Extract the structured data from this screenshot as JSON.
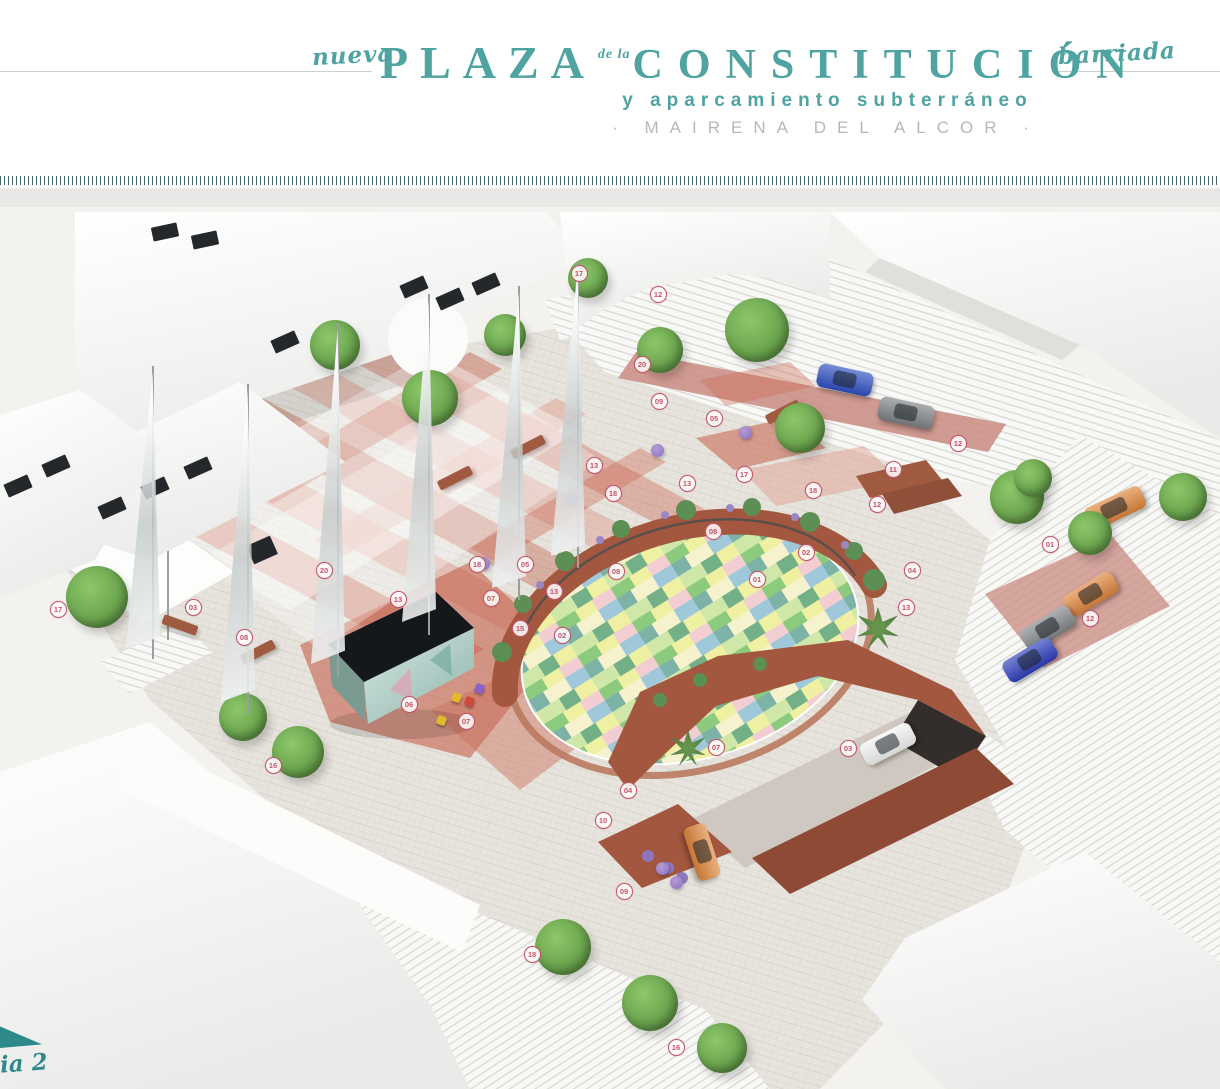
{
  "header": {
    "pre_title": "nueva",
    "title_main": "PLAZA",
    "title_connector": "de la",
    "title_secondary": "CONSTITUCIÓN",
    "post_title": "barriada",
    "subtitle": "y aparcamiento subterráneo",
    "location": "· MAIRENA  DEL  ALCOR ·"
  },
  "logo": {
    "visible_text": "ia 2"
  },
  "palette": {
    "accent": "#4fa3a1",
    "accentDark": "#2e8a8a",
    "locGray": "#b5b8ba",
    "marker": "#c2556b",
    "wall": "#a3573e",
    "redBand": "#cd6c58",
    "pave": "#e7e4de",
    "sceneBg": "#f3f2ee",
    "mosaicColors": "#8ccb7e #eff0a2 #f2cdd1 #7db3a6 #9fc9da #f6f2cd #cfe7a8 #74b087"
  },
  "scene": {
    "type": "aerial-architectural-render",
    "markers": [
      {
        "label": "17",
        "x": 578,
        "y": 272
      },
      {
        "label": "12",
        "x": 657,
        "y": 293
      },
      {
        "label": "20",
        "x": 641,
        "y": 363
      },
      {
        "label": "09",
        "x": 658,
        "y": 400
      },
      {
        "label": "05",
        "x": 713,
        "y": 417
      },
      {
        "label": "12",
        "x": 957,
        "y": 442
      },
      {
        "label": "13",
        "x": 593,
        "y": 464
      },
      {
        "label": "11",
        "x": 892,
        "y": 468
      },
      {
        "label": "17",
        "x": 743,
        "y": 473
      },
      {
        "label": "13",
        "x": 686,
        "y": 482
      },
      {
        "label": "18",
        "x": 812,
        "y": 489
      },
      {
        "label": "18",
        "x": 612,
        "y": 492
      },
      {
        "label": "12",
        "x": 876,
        "y": 503
      },
      {
        "label": "08",
        "x": 712,
        "y": 530
      },
      {
        "label": "01",
        "x": 1049,
        "y": 543
      },
      {
        "label": "02",
        "x": 805,
        "y": 551
      },
      {
        "label": "18",
        "x": 476,
        "y": 563
      },
      {
        "label": "05",
        "x": 524,
        "y": 563
      },
      {
        "label": "04",
        "x": 911,
        "y": 569
      },
      {
        "label": "20",
        "x": 323,
        "y": 569
      },
      {
        "label": "08",
        "x": 615,
        "y": 570
      },
      {
        "label": "01",
        "x": 756,
        "y": 578
      },
      {
        "label": "13",
        "x": 553,
        "y": 590
      },
      {
        "label": "07",
        "x": 490,
        "y": 597
      },
      {
        "label": "13",
        "x": 397,
        "y": 598
      },
      {
        "label": "13",
        "x": 905,
        "y": 606
      },
      {
        "label": "03",
        "x": 192,
        "y": 606
      },
      {
        "label": "17",
        "x": 57,
        "y": 608
      },
      {
        "label": "12",
        "x": 1089,
        "y": 617
      },
      {
        "label": "15",
        "x": 519,
        "y": 627
      },
      {
        "label": "02",
        "x": 561,
        "y": 634
      },
      {
        "label": "08",
        "x": 243,
        "y": 636
      },
      {
        "label": "06",
        "x": 408,
        "y": 703
      },
      {
        "label": "07",
        "x": 465,
        "y": 720
      },
      {
        "label": "07",
        "x": 715,
        "y": 746
      },
      {
        "label": "03",
        "x": 847,
        "y": 747
      },
      {
        "label": "16",
        "x": 272,
        "y": 764
      },
      {
        "label": "04",
        "x": 627,
        "y": 789
      },
      {
        "label": "10",
        "x": 602,
        "y": 819
      },
      {
        "label": "09",
        "x": 623,
        "y": 890
      },
      {
        "label": "18",
        "x": 531,
        "y": 953
      },
      {
        "label": "16",
        "x": 675,
        "y": 1046
      }
    ],
    "cars": [
      {
        "color": "#2e4fc4",
        "x": 845,
        "y": 380,
        "rot": 12
      },
      {
        "color": "#7e8184",
        "x": 906,
        "y": 413,
        "rot": 12
      },
      {
        "color": "#e0863c",
        "x": 1115,
        "y": 508,
        "rot": -25,
        "len": 62
      },
      {
        "color": "#e0863c",
        "x": 1091,
        "y": 594,
        "rot": -31
      },
      {
        "color": "#84878a",
        "x": 1048,
        "y": 628,
        "rot": -31
      },
      {
        "color": "#2e3fbf",
        "x": 1030,
        "y": 660,
        "rot": -31
      },
      {
        "color": "#e0863c",
        "x": 702,
        "y": 852,
        "rot": 72
      },
      {
        "color": "#f4f4f2",
        "x": 888,
        "y": 744,
        "rot": -27
      }
    ],
    "trees": [
      {
        "x": 588,
        "y": 278,
        "d": 40
      },
      {
        "x": 757,
        "y": 330,
        "d": 64
      },
      {
        "x": 800,
        "y": 428,
        "d": 50
      },
      {
        "x": 660,
        "y": 350,
        "d": 46
      },
      {
        "x": 335,
        "y": 345,
        "d": 50
      },
      {
        "x": 430,
        "y": 398,
        "d": 56
      },
      {
        "x": 505,
        "y": 335,
        "d": 42
      },
      {
        "x": 97,
        "y": 597,
        "d": 62
      },
      {
        "x": 243,
        "y": 717,
        "d": 48
      },
      {
        "x": 298,
        "y": 752,
        "d": 52
      },
      {
        "x": 563,
        "y": 947,
        "d": 56
      },
      {
        "x": 650,
        "y": 1003,
        "d": 56
      },
      {
        "x": 722,
        "y": 1048,
        "d": 50
      },
      {
        "x": 1017,
        "y": 497,
        "d": 54
      },
      {
        "x": 1090,
        "y": 533,
        "d": 44
      },
      {
        "x": 1183,
        "y": 497,
        "d": 48
      },
      {
        "x": 1033,
        "y": 478,
        "d": 38
      },
      {
        "x": 878,
        "y": 628,
        "d": 42,
        "type": "palm"
      },
      {
        "x": 688,
        "y": 748,
        "d": 36,
        "type": "palm"
      }
    ],
    "sails": [
      {
        "x": 152,
        "top": 372,
        "base": 648
      },
      {
        "x": 247,
        "top": 390,
        "base": 702
      },
      {
        "x": 337,
        "top": 330,
        "base": 664
      },
      {
        "x": 428,
        "top": 300,
        "base": 622
      },
      {
        "x": 518,
        "top": 292,
        "base": 588
      },
      {
        "x": 577,
        "top": 268,
        "base": 556
      }
    ],
    "windows": [
      {
        "x": 112,
        "y": 508
      },
      {
        "x": 155,
        "y": 488
      },
      {
        "x": 198,
        "y": 468
      },
      {
        "x": 414,
        "y": 287
      },
      {
        "x": 450,
        "y": 299
      },
      {
        "x": 486,
        "y": 284
      },
      {
        "x": 18,
        "y": 486
      },
      {
        "x": 56,
        "y": 466
      },
      {
        "x": 165,
        "y": 232,
        "rot": -12
      },
      {
        "x": 205,
        "y": 240,
        "rot": -12
      },
      {
        "x": 285,
        "y": 342
      },
      {
        "x": 262,
        "y": 550,
        "w": 26,
        "h": 20
      }
    ],
    "benches": [
      {
        "x": 455,
        "y": 478
      },
      {
        "x": 528,
        "y": 447
      },
      {
        "x": 783,
        "y": 412
      },
      {
        "x": 258,
        "y": 652
      },
      {
        "x": 180,
        "y": 625,
        "rot": 20
      }
    ],
    "pots": [
      {
        "x": 483,
        "y": 563
      },
      {
        "x": 571,
        "y": 499
      },
      {
        "x": 657,
        "y": 450
      },
      {
        "x": 745,
        "y": 432
      },
      {
        "x": 662,
        "y": 868
      },
      {
        "x": 676,
        "y": 882
      }
    ],
    "chairs": [
      {
        "x": 456,
        "y": 697,
        "c": "#e3b72e"
      },
      {
        "x": 469,
        "y": 701,
        "c": "#cf4a3a"
      },
      {
        "x": 479,
        "y": 688,
        "c": "#8a63c9"
      },
      {
        "x": 441,
        "y": 720,
        "c": "#e3b72e"
      },
      {
        "x": 492,
        "y": 598,
        "c": "#e3b72e"
      }
    ]
  }
}
